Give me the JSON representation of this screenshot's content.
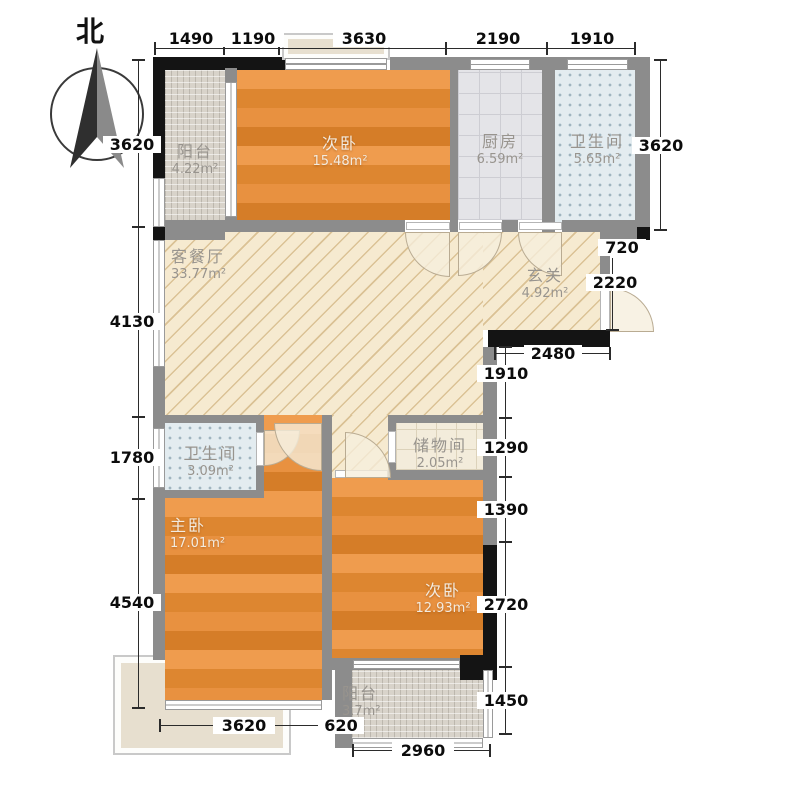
{
  "compass": {
    "label": "北"
  },
  "rooms": {
    "balcony_top": {
      "name": "阳台",
      "area": "4.22m²"
    },
    "bedroom_top": {
      "name": "次卧",
      "area": "15.48m²"
    },
    "kitchen": {
      "name": "厨房",
      "area": "6.59m²"
    },
    "bath_top": {
      "name": "卫生间",
      "area": "5.65m²"
    },
    "living": {
      "name": "客餐厅",
      "area": "33.77m²"
    },
    "entry": {
      "name": "玄关",
      "area": "4.92m²"
    },
    "bath_mid": {
      "name": "卫生间",
      "area": "3.09m²"
    },
    "storage": {
      "name": "储物间",
      "area": "2.05m²"
    },
    "master": {
      "name": "主卧",
      "area": "17.01m²"
    },
    "bedroom_bottom": {
      "name": "次卧",
      "area": "12.93m²"
    },
    "balcony_bottom": {
      "name": "阳台",
      "area": "3.7m²"
    }
  },
  "dimensions": {
    "top": [
      "1490",
      "1190",
      "3630",
      "2190",
      "1910"
    ],
    "left": [
      "3620",
      "4130",
      "1780",
      "4540"
    ],
    "right_outer": [
      "3620",
      "720",
      "2220",
      "2480"
    ],
    "right_inner": [
      "1910",
      "1290",
      "1390",
      "2720",
      "1450"
    ],
    "bottom": [
      "3620",
      "620",
      "2960"
    ]
  },
  "colors": {
    "wall": "#8c8c8c",
    "wall_black": "#141414",
    "wood_floor": "#e08a35",
    "living_floor": "#f6ead0",
    "bath_tile": "#e3ecf0"
  }
}
